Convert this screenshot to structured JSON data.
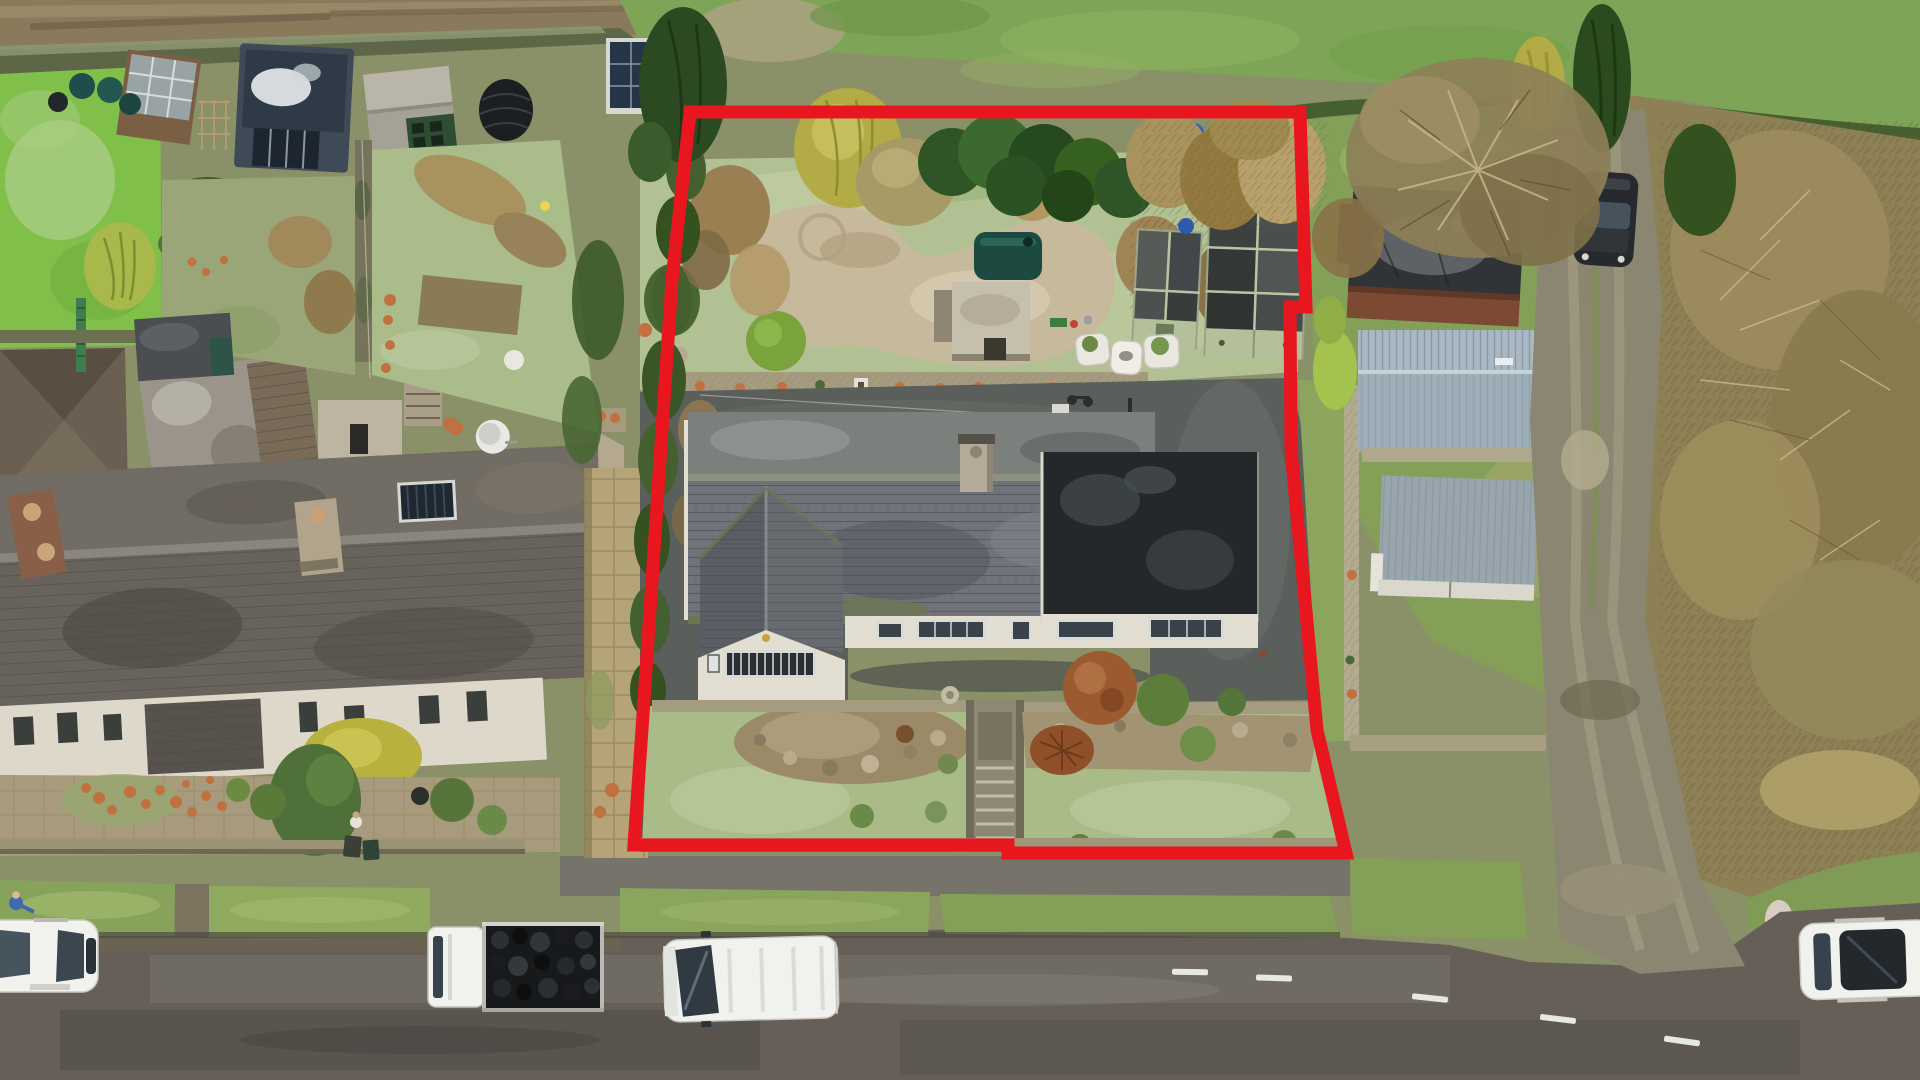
{
  "meta": {
    "type": "aerial-drone-photograph",
    "subject": "detached bungalow and garden plot outlined for sale",
    "annotation": "red property boundary outline",
    "conditions": "winter, frosty lawns, wet road"
  },
  "colors": {
    "boundary": "#e8161f",
    "slate": "#70747a",
    "slate_upper": "#7d8184",
    "slate_dark": "#5a5e63",
    "flat_roof": "#25282a",
    "wall": "#e2ded2",
    "terrace_roof": "#67635c",
    "lawn": "#a9bb87",
    "lawn_bright": "#7fbf4a",
    "lawn_frost": "#b2c194",
    "gravel": "#c7b99c",
    "tarmac": "#5b5f5b",
    "road": "#655f58",
    "footway": "#76736a",
    "verge": "#87a35b",
    "field": "#7da457",
    "scrub": "#8d8055",
    "hedge": "#2f5526",
    "hedge_brown": "#a8925e",
    "stone": "#a59c80",
    "stone_wall": "#b3ab90",
    "brick": "#7c4a33",
    "metal_roof": "#a9b8c2",
    "shed_green": "#b4c09a",
    "shed_roof": "#42474a",
    "oil_tank": "#1d4a40",
    "terracotta": "#c1703f",
    "vehicle_white": "#f1f2ee",
    "glass": "#37434c",
    "coal": "#17191b",
    "person_blue": "#3d6ab0",
    "track": "#8a7a5c",
    "golden_tree": "#b3ab45",
    "copper_bush": "#9c5a30",
    "dark_car": "#26292d",
    "blue_barrel": "#2f64c4",
    "lane": "#8b8671"
  },
  "scene": {
    "boundary_polygon_px": [
      [
        690,
        112
      ],
      [
        1300,
        112
      ],
      [
        1306,
        307
      ],
      [
        1290,
        307
      ],
      [
        1291,
        450
      ],
      [
        1317,
        730
      ],
      [
        1346,
        853
      ],
      [
        1008,
        853
      ],
      [
        1008,
        845
      ],
      [
        634,
        845
      ],
      [
        644,
        700
      ],
      [
        672,
        280
      ]
    ],
    "buildings": [
      {
        "name": "subject-bungalow",
        "roof": "grey slate, mossy, hipped front wing, brick chimney, black flat-roof extension"
      },
      {
        "name": "terraced-stone-cottages",
        "position": "left",
        "roof": "dark weathered slate, two chimneys, satellite dish, solar panel"
      },
      {
        "name": "garden-office-cabin",
        "position": "top-left",
        "detail": "glossy dark roof with sky reflection, glazed doors"
      },
      {
        "name": "pale-green-glazed-sheds",
        "count": 2,
        "position": "inside plot, top-right"
      },
      {
        "name": "stone-outbuilding-with-oil-tank",
        "position": "inside plot"
      },
      {
        "name": "brick-shed",
        "position": "right of plot"
      },
      {
        "name": "corrugated-metal-sheds",
        "count": 2,
        "position": "right of plot"
      }
    ],
    "vehicles": [
      {
        "name": "parked-white-car",
        "position": "bottom-left, partly out of frame",
        "extra": "person in blue at rear"
      },
      {
        "name": "flatbed-truck-with-coal-bags",
        "position": "bottom-left on road"
      },
      {
        "name": "white-van-driving",
        "position": "bottom-centre on road"
      },
      {
        "name": "white-suv",
        "position": "bottom-right, partly out of frame",
        "extra": "dark panoramic roof"
      },
      {
        "name": "black-hatchback",
        "position": "top-right on lane"
      }
    ],
    "landscape": [
      "muddy farm track top-left",
      "green field above plot",
      "bare scrub woodland right",
      "kidney-shaped gravel patio",
      "frosty lawns",
      "stone steps to road",
      "copper beech ball shrub",
      "golden conifer",
      "cypress hedge",
      "road with white centre dashes"
    ]
  }
}
